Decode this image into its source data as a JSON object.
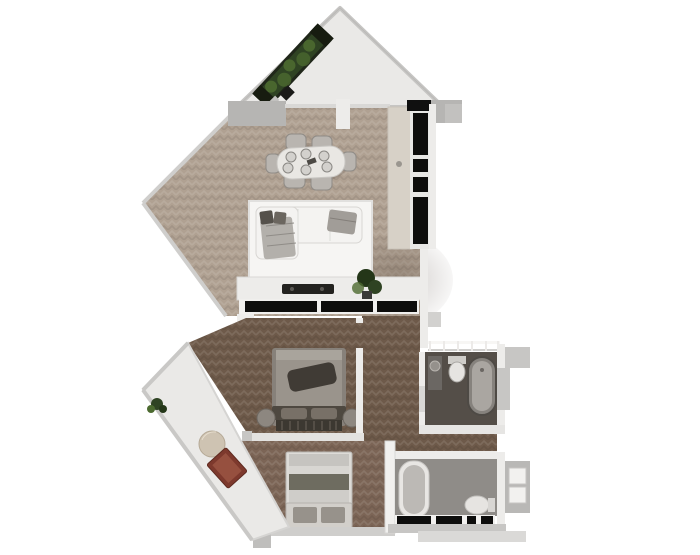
{
  "meta": {
    "title": "3D rendered apartment floor plan, top-down view",
    "style": "photoreal dollhouse render, no visible text"
  },
  "palette": {
    "bg": "#ffffff",
    "wall_gray": "#c7c6c4",
    "wall_gray_dark": "#b6b5b3",
    "wall_white": "#edecea",
    "balcony_floor": "#eae9e7",
    "wood_light": "#b0a192",
    "wood_dark": "#6e5a4a",
    "wood_dark2": "#7c6556",
    "bath1_floor": "#544e48",
    "bath2_floor": "#8f8c88",
    "black_panel": "#0d0d0c",
    "cream_counter": "#d7d1c7",
    "rug": "#f6f5f3",
    "sofa_white": "#f4f3f1",
    "throw_gray": "#b3b0ab",
    "green_dark": "#2f4323",
    "green_mid": "#4c6a30",
    "planter_box": "#20271a",
    "red_mat": "#7d392d",
    "red_mat_light": "#96503f",
    "pouf": "#cec3b2",
    "bed1_duvet": "#9a948c",
    "bed1_throw": "#403b35",
    "bed1_head": "#4e4840",
    "bed2_duvet": "#d8d6d2",
    "bed2_band": "#6e6c60",
    "bed2_head": "#d2cfca",
    "tub_outer": "#86827d",
    "tub_inner": "#aaa6a1",
    "fixture_white": "#e6e4e1",
    "table_white": "#e9e7e3",
    "chair_gray": "#b9b5b0",
    "soundbar": "#23221f"
  },
  "rooms": [
    {
      "id": "top-balcony",
      "name": "triangular balcony with planter",
      "floor": "balcony_floor"
    },
    {
      "id": "living-dining",
      "name": "open living / dining room",
      "floor": "wood_light"
    },
    {
      "id": "kitchen-unit",
      "name": "tall black kitchen cabinet wall",
      "floor": "wood_light"
    },
    {
      "id": "hallway",
      "name": "hallway",
      "floor": "wood_dark"
    },
    {
      "id": "bedroom-1",
      "name": "middle bedroom",
      "floor": "wood_dark"
    },
    {
      "id": "bedroom-2",
      "name": "lower bedroom",
      "floor": "wood_dark2"
    },
    {
      "id": "bathroom-1",
      "name": "upper bathroom with freestanding tub",
      "floor": "bath1_floor"
    },
    {
      "id": "bathroom-2",
      "name": "lower bathroom with tub and toilet",
      "floor": "bath2_floor"
    },
    {
      "id": "lower-balcony",
      "name": "lower-left balcony with pouf, red mat and plant",
      "floor": "balcony_floor"
    }
  ],
  "furniture": [
    "planter-box",
    "dining-table",
    "dining-chairs-x6",
    "plates-x6",
    "corner-sofa",
    "area-rug",
    "media-console",
    "soundbar",
    "potted-plant",
    "kitchen-counter",
    "black-cabinet-panels",
    "double-bed-1",
    "nightstands-x2",
    "double-bed-2",
    "freestanding-bathtub",
    "built-in-bathtub",
    "toilet-x2",
    "vanity-sink",
    "balcony-pouf",
    "red-mat",
    "small-plants-x2",
    "juliet-railing",
    "ac-unit-exterior"
  ]
}
